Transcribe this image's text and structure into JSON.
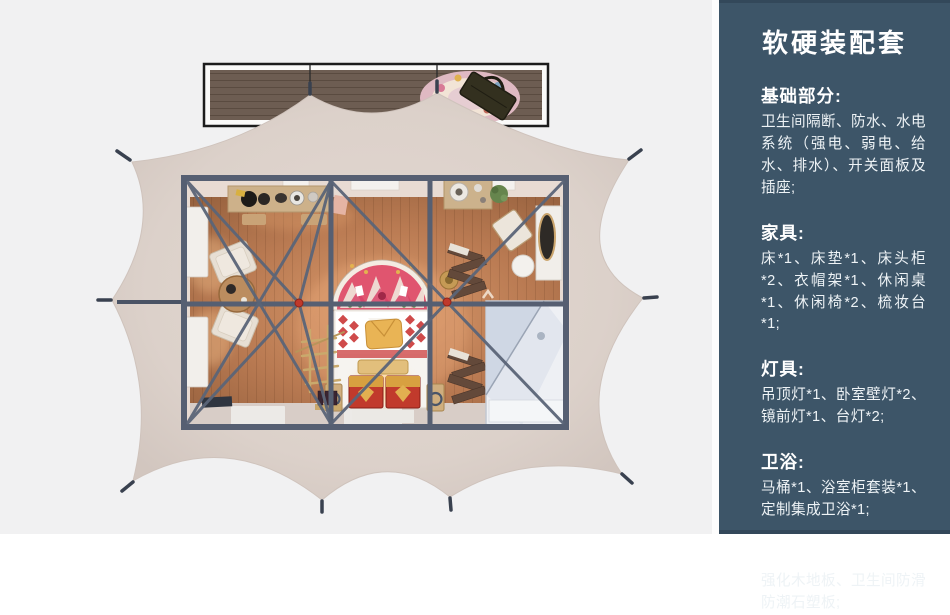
{
  "palette": {
    "background": "#f1f1f2",
    "sidebar_bg": "#3d5568",
    "sidebar_text": "#f2f5f7",
    "tent_fabric": "#ddd2cb",
    "steel_frame": "#565f72",
    "wood_floor": "#b97a52",
    "deck_wood": "#6d5d52",
    "joint_red": "#c0392b",
    "rug_pink": "#e0556f",
    "chest_red": "#c13a2c"
  },
  "sidebar": {
    "title": "软硬装配套",
    "sections": [
      {
        "heading": "基础部分:",
        "body": "卫生间隔断、防水、水电系统（强电、弱电、给水、排水）、开关面板及插座;"
      },
      {
        "heading": "家具:",
        "body": "床*1、床垫*1、床头柜*2、衣帽架*1、休闲桌*1、休闲椅*2、梳妆台*1;"
      },
      {
        "heading": "灯具:",
        "body": "吊顶灯*1、卧室壁灯*2、镜前灯*1、台灯*2;"
      },
      {
        "heading": "卫浴:",
        "body": "马桶*1、浴室柜套装*1、定制集成卫浴*1;"
      },
      {
        "heading": "地面:",
        "body": "强化木地板、卫生间防滑防潮石塑板;"
      }
    ]
  },
  "scene": {
    "items": [
      "tent-canopy",
      "wood-deck",
      "deck-rug",
      "deck-bag",
      "ground-stakes",
      "steel-frame",
      "joint-markers",
      "wood-floor",
      "windows",
      "bed",
      "headboard-rug",
      "pillow",
      "storage-chests",
      "bedside-stools",
      "clothes-rack",
      "lounge-chairs",
      "coffee-table",
      "console-table",
      "washbasin-counter",
      "plant",
      "dressing-table",
      "mirror",
      "vanity-stool",
      "folding-chairs",
      "integrated-bathroom",
      "floor-mats"
    ]
  }
}
